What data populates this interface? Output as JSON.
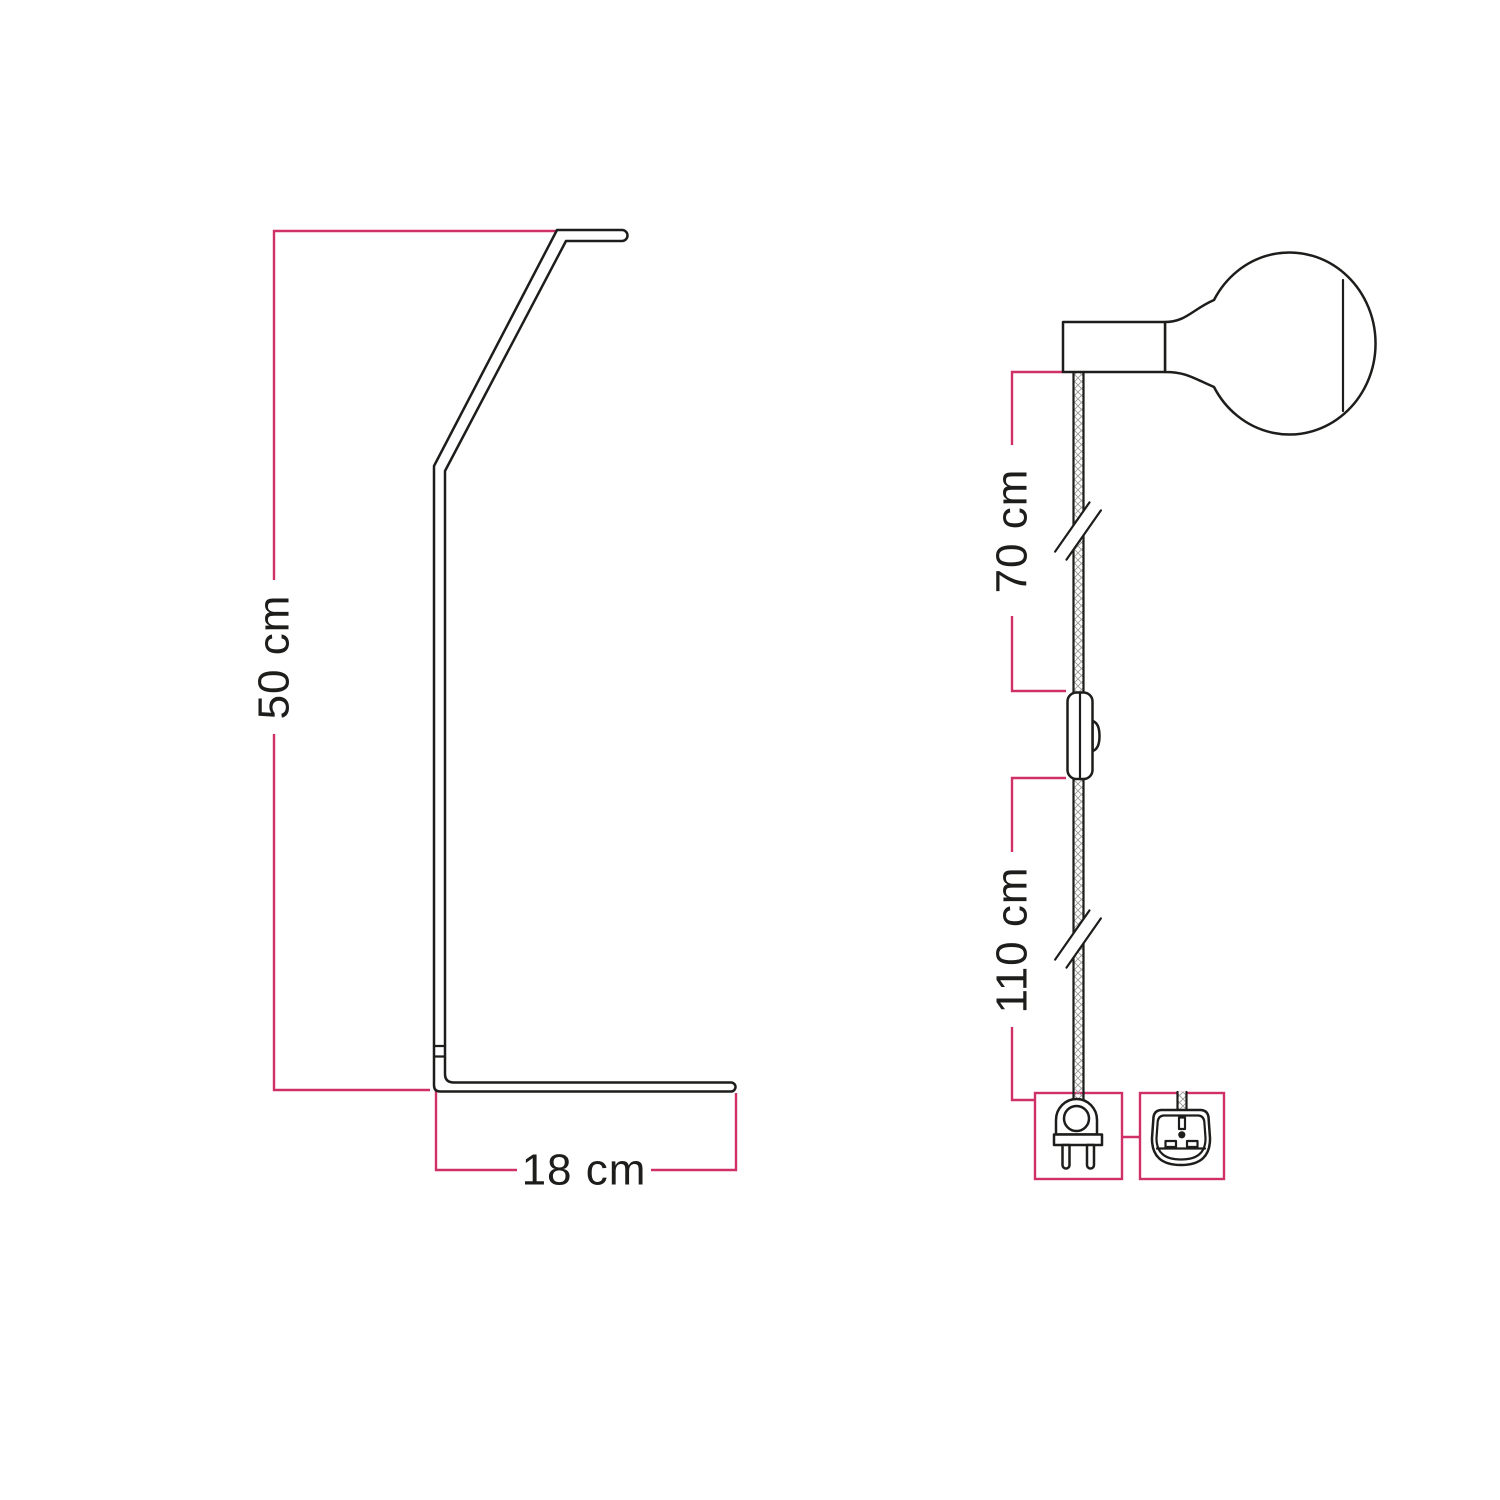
{
  "colors": {
    "background": "#ffffff",
    "outline": "#1d1d1b",
    "dimension": "#d03068",
    "hatch": "#9b9b9b"
  },
  "stand": {
    "height_label": "50 cm",
    "base_label": "18 cm"
  },
  "pendant": {
    "upper_cable_label": "70 cm",
    "lower_cable_label": "110 cm",
    "plug_options": [
      {
        "icon": "euro-plug-icon"
      },
      {
        "icon": "uk-plug-icon"
      }
    ]
  }
}
